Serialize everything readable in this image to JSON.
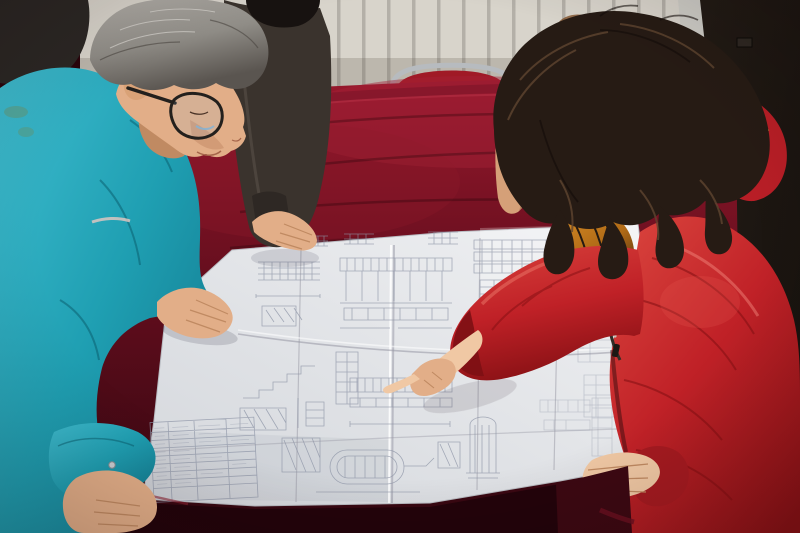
{
  "scene": {
    "colors": {
      "wall": "#d8d4cb",
      "wall_fin": "#aeaaa2",
      "door": "#17120e",
      "door_frame": "#cdccc6",
      "stain": "#7b4a22",
      "chair_metal": "#b7bbbf",
      "chair_back": "#a01a26",
      "velvet_bright": "#97182c",
      "velvet_mid": "#5f0d1c",
      "velvet_dark": "#320710",
      "velvet_front": "#23040b",
      "velvet_edge": "#6d1020",
      "paper_light": "#f0f1f3",
      "paper_dark": "#d4d7dc",
      "ink": "#8d94a6",
      "teal_light": "#3fbdd0",
      "teal": "#1f9fb2",
      "teal_dark": "#10758a",
      "hair_gray_light": "#b3b0aa",
      "hair_gray": "#8f8c86",
      "hair_gray_dark": "#5a5550",
      "skin_light": "#f0c8a4",
      "skin": "#e2ae88",
      "skin_dark": "#c08a62",
      "dark_jacket": "#3a332d",
      "dark_jacket_cuff": "#2e2824",
      "black_hair": "#171210",
      "coat_light": "#d8423c",
      "coat": "#c02127",
      "coat_dark": "#8c1216",
      "hood_red": "#b81e26",
      "woman_hair": "#261b14",
      "woman_hair_light": "#5f452f",
      "fur_light": "#d98f28",
      "fur": "#b06a16",
      "fur_dark": "#4a2c10",
      "glasses": "#23201d",
      "trousers": "#3e342b"
    }
  }
}
